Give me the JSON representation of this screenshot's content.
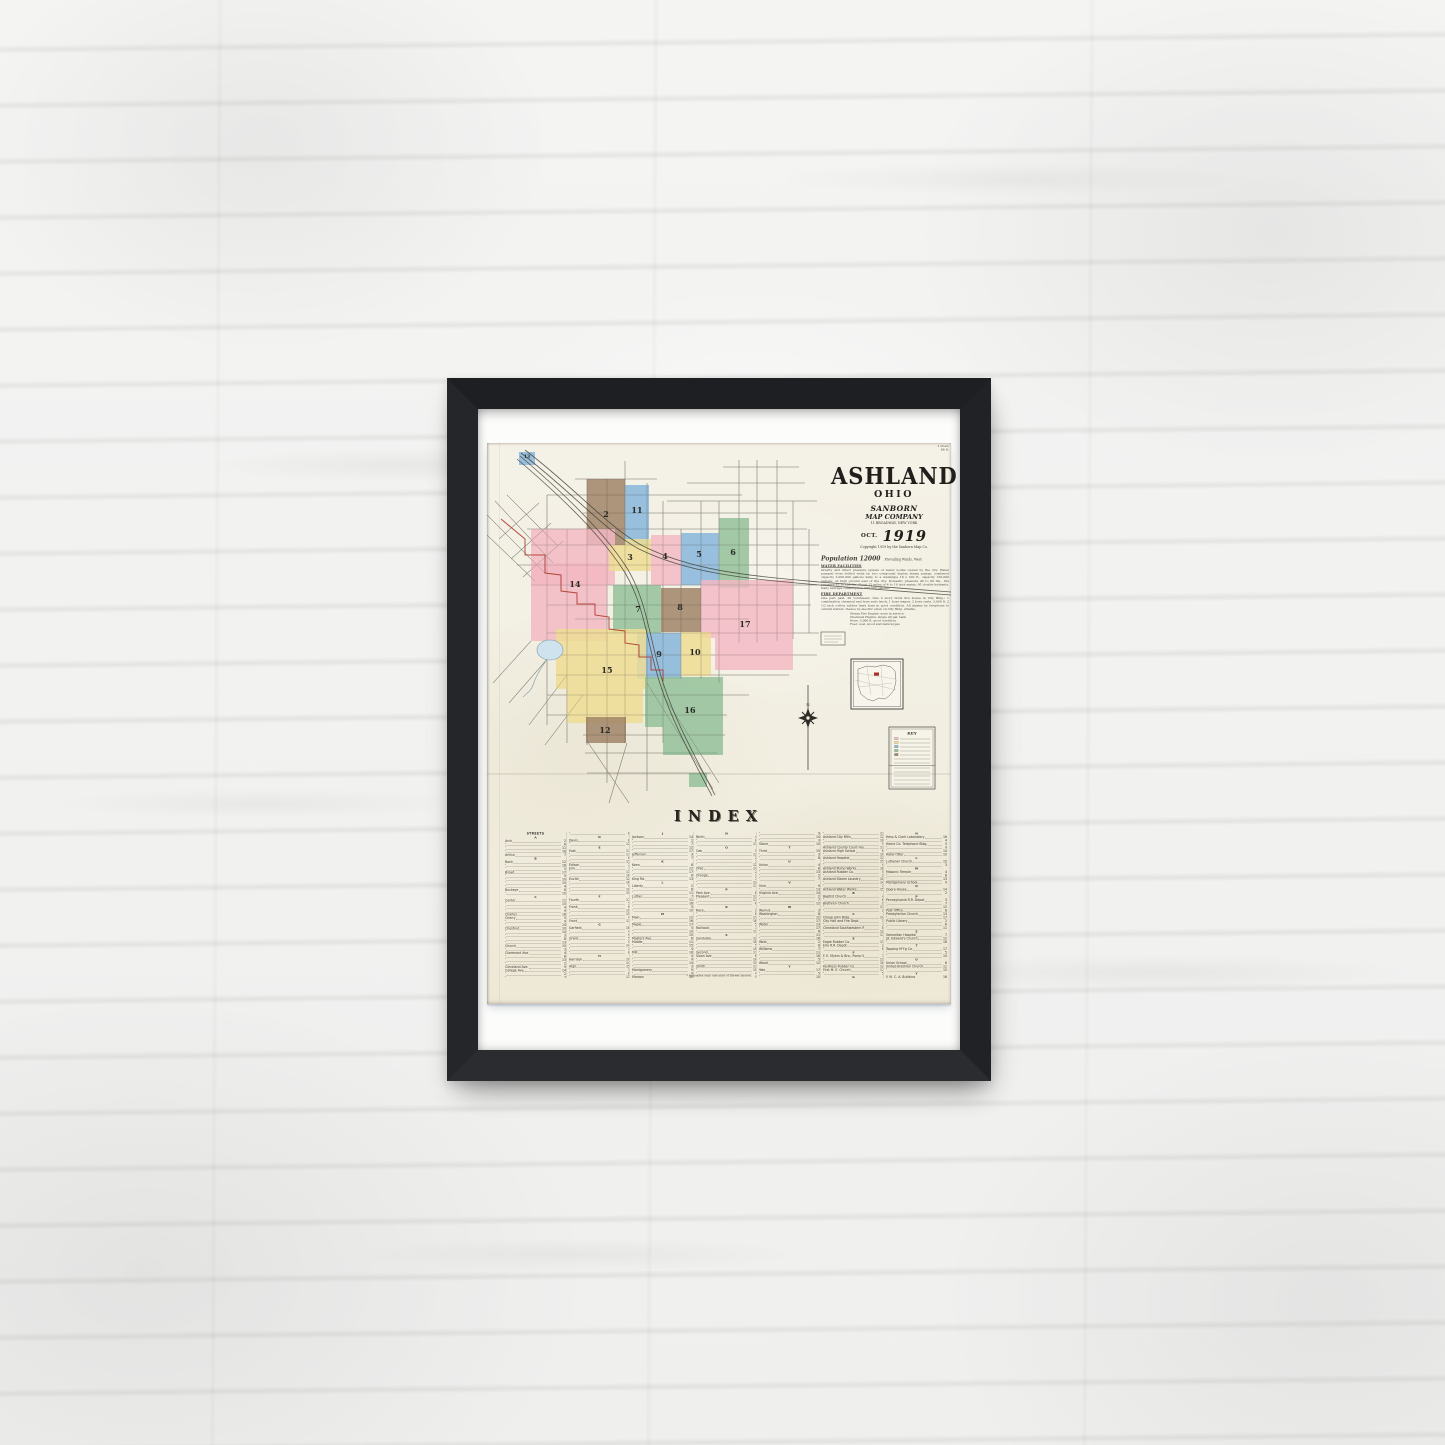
{
  "poster": {
    "title": "ASHLAND",
    "subtitle": "OHIO",
    "publisher_line1": "SANBORN",
    "publisher_line2": "MAP COMPANY",
    "address": "11 BROADWAY, NEW YORK",
    "date_prefix": "OCT.",
    "date_year": "1919",
    "copyright": "Copyright 1919 by the Sanborn Map Co.",
    "corner_note": [
      "1 Chain",
      "66 ft."
    ],
    "population_line": "Population 12000",
    "winds_note": "Prevailing Winds, West",
    "sections": {
      "water": {
        "heading": "WATER FACILITIES",
        "body": "Gravity and direct pressure system of water works owned by the city. Water pumped from drilled wells by two compound duplex steam pumps, combined capacity 2,000,000 gallons daily, to a standpipe 16 x 100 ft., capacity 150,000 gallons, on high ground east of the city. Domestic pressure 40 to 60 lbs., fire pressure 85 to 100 lbs. About 12 miles of 4 to 10 inch mains; 95 double hydrants. Daily average consumption 500,000 gallons."
      },
      "fire": {
        "heading": "FIRE DEPARTMENT",
        "body": "One part paid, 20 volunteers. One 2 story brick fire house in City Bldg.; 1 combination chemical and hose auto truck, 1 hose wagon, 2 hose carts, 3,000 ft. 2 1/2 inch cotton rubber lined hose in good condition. All alarms by telephone to central station, thence by electric siren on City Bldg. whistle.",
        "list": [
          "Steam Fire Engine: none in service",
          "Chemical Engine: single 40 gal. tank",
          "Hose: 3,000 ft. good condition",
          "Fuel: coal, wood and natural gas"
        ]
      }
    },
    "index": {
      "title": "INDEX",
      "streets_header": "STREETS",
      "specials_header": "SPECIALS",
      "footnote": "* Indicates only one side of Street shown.",
      "streets": [
        "Arch",
        "Arthur",
        "Bank",
        "Broad",
        "Buckeye",
        "Center",
        "Charles",
        "Cherry",
        "Chestnut",
        "Church",
        "Claremont Ave.",
        "Cleveland Ave.",
        "College Ave.",
        "Cottage",
        "Davis",
        "East",
        "Edison",
        "Elm",
        "Euclid",
        "Fourth",
        "Frank",
        "Front",
        "Garfield",
        "Grant",
        "Harrison",
        "High",
        "Hill",
        "Home",
        "Jackson",
        "Jefferson",
        "Keen",
        "King Rd.",
        "Liberty",
        "Luther",
        "Main",
        "Maple",
        "Masters Ave.",
        "Middle",
        "Mill",
        "Montgomery",
        "Morgan",
        "Myers Ave.",
        "Ninth",
        "Oak",
        "Ohio",
        "Orange",
        "Park Ave.",
        "Pleasant",
        "Race",
        "Railroad",
        "Sandusky",
        "Second",
        "Sloan Ave.",
        "Smith",
        "Spring",
        "State",
        "Stone",
        "Third",
        "Union",
        "Vine",
        "Virginia Ave.",
        "Walnut",
        "Washington",
        "Water",
        "West",
        "Williams",
        "Wood",
        "Yale"
      ],
      "specials": [
        "A. L. Garber Printing Co.",
        "Ashland Cemetery",
        "Ashland City Mills",
        "Ashland County Court House",
        "Ashland High School",
        "Ashland Hospital",
        "Ashland Pump Works",
        "Ashland Rubber Co.",
        "Ashland Steam Laundry",
        "Ashland Water Works",
        "Baptist Church",
        "Brethren Church",
        "Cheap John Bldg.",
        "City Hall and Fire Dept.",
        "Cleveland Southwestern Ry.",
        "Eagle Rubber Co.",
        "Erie R.R. Depot",
        "F. E. Myers & Bro., Pump Wks.",
        "Faultless Rubber Co.",
        "First M. E. Church",
        "Gamble Creek",
        "Grace Reformed Church",
        "Hess & Clark Laboratory",
        "Home Co. Telephone Bldg.",
        "Hotel Otter",
        "Lutheran Church",
        "Masonic Temple",
        "Montgomery School",
        "Opera House",
        "Pennsylvania R.R. Depot",
        "Post Office",
        "Presbyterian Church",
        "Public Library",
        "Samaritan Hospital",
        "St. Edward's Church",
        "Topping M'f'g Co.",
        "Union School",
        "United Brethren Church",
        "Y. M. C. A. Building"
      ]
    },
    "map": {
      "compass_label": "N",
      "key_title": "KEY",
      "colors": {
        "pink": "#f3b9c3",
        "yellow": "#eedd92",
        "blue": "#85b5da",
        "green": "#93c098",
        "brown": "#9e8366",
        "red_line": "#a93226",
        "water": "#cfe3ee"
      },
      "districts": [
        {
          "n": "13",
          "color": "blue",
          "s": 1,
          "rects": [
            [
              32,
              9,
              16,
              13
            ]
          ],
          "label": [
            40,
            15
          ]
        },
        {
          "n": "2",
          "color": "brown",
          "rects": [
            [
              100,
              36,
              38,
              66
            ]
          ],
          "label": [
            119,
            74
          ]
        },
        {
          "n": "11",
          "color": "blue",
          "rects": [
            [
              138,
              42,
              24,
              60
            ]
          ],
          "label": [
            150,
            70
          ]
        },
        {
          "n": "14",
          "color": "pink",
          "rects": [
            [
              44,
              86,
              84,
              56
            ],
            [
              44,
              120,
              76,
              78
            ]
          ],
          "label": [
            88,
            144
          ]
        },
        {
          "n": "3",
          "color": "yellow",
          "rects": [
            [
              122,
              102,
              42,
              26
            ],
            [
              138,
              96,
              26,
              8
            ]
          ],
          "label": [
            143,
            117
          ]
        },
        {
          "n": "4",
          "color": "pink",
          "rects": [
            [
              164,
              92,
              30,
              50
            ]
          ],
          "label": [
            178,
            116
          ]
        },
        {
          "n": "5",
          "color": "blue",
          "rects": [
            [
              194,
              90,
              38,
              52
            ]
          ],
          "label": [
            212,
            114
          ]
        },
        {
          "n": "6",
          "color": "green",
          "rects": [
            [
              232,
              75,
              30,
              70
            ]
          ],
          "label": [
            246,
            112
          ]
        },
        {
          "n": "7",
          "color": "green",
          "rects": [
            [
              126,
              142,
              48,
              48
            ]
          ],
          "label": [
            151,
            169
          ]
        },
        {
          "n": "8",
          "color": "brown",
          "rects": [
            [
              174,
              145,
              40,
              44
            ]
          ],
          "label": [
            193,
            167
          ]
        },
        {
          "n": "17",
          "color": "pink",
          "rects": [
            [
              214,
              137,
              92,
              58
            ],
            [
              228,
              195,
              78,
              32
            ]
          ],
          "label": [
            258,
            184
          ]
        },
        {
          "n": "9",
          "color": "blue",
          "rects": [
            [
              150,
              190,
              44,
              46
            ]
          ],
          "label": [
            172,
            214
          ]
        },
        {
          "n": "10",
          "color": "yellow",
          "rects": [
            [
              194,
              189,
              30,
              44
            ]
          ],
          "label": [
            208,
            212
          ]
        },
        {
          "n": "15",
          "color": "yellow",
          "rects": [
            [
              69,
              186,
              90,
              60
            ],
            [
              80,
              246,
              76,
              34
            ]
          ],
          "label": [
            120,
            230
          ]
        },
        {
          "n": "16",
          "color": "green",
          "rects": [
            [
              158,
              234,
              78,
              50
            ],
            [
              176,
              284,
              60,
              28
            ]
          ],
          "label": [
            203,
            270
          ]
        },
        {
          "n": "12",
          "color": "brown",
          "rects": [
            [
              99,
              274,
              40,
              26
            ]
          ],
          "label": [
            118,
            290
          ]
        },
        {
          "n": "",
          "color": "green",
          "rects": [
            [
              202,
              330,
              18,
              14
            ]
          ],
          "label": [
            211,
            338
          ]
        }
      ]
    }
  }
}
